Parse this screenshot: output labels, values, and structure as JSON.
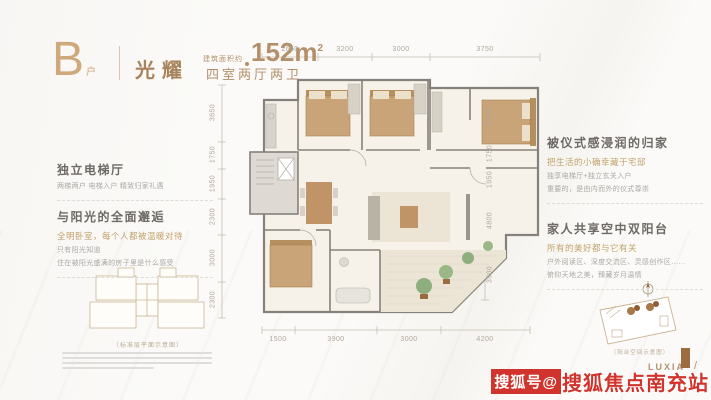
{
  "header": {
    "unit": "B",
    "unit_suffix": "户",
    "name": "光耀",
    "area_prefix": "建筑面积约",
    "area_value": "152m",
    "area_sup": "2",
    "layout": "四室两厅两卫"
  },
  "features_left": [
    {
      "title": "独立电梯厅",
      "lines": [
        "两梯两户 电梯入户 精致归家礼遇"
      ]
    },
    {
      "title": "与阳光的全面邂逅",
      "gold": "全明卧室，每个人都被温暖对待",
      "lines": [
        "只有阳光知道",
        "住在被阳光盛满的房子里是什么感受"
      ]
    }
  ],
  "features_right": [
    {
      "title": "被仪式感浸润的归家",
      "gold": "把生活的小确幸藏于宅邸",
      "lines": [
        "独享电梯厅+独立玄关入户",
        "重要的，是由内而外的仪式尊崇"
      ]
    },
    {
      "title": "家人共享空中双阳台",
      "gold": "所有的美好都与它有关",
      "lines": [
        "户外阅读区、深度交流区、灵感创作区……",
        "俯仰天地之美，臻藏岁月温情"
      ]
    }
  ],
  "floorplan": {
    "dims_top": [
      "2650",
      "3200",
      "3000",
      "3750"
    ],
    "dims_bottom": [
      "1500",
      "3900",
      "3000",
      "4200"
    ],
    "dims_left": [
      "3650",
      "1750",
      "1950",
      "2300",
      "3000",
      "2300"
    ],
    "dims_right": [
      "5400",
      "1750",
      "1950",
      "4800",
      "3900"
    ]
  },
  "footer": {
    "keyplan_caption": "（标准层平面示意图）",
    "balcony_caption": "（阳台空间示意图）",
    "logo": "LUXIA",
    "watermark_prefix": "搜狐号@",
    "watermark_name": "搜狐焦点南充站"
  },
  "colors": {
    "accent_bronze": "#b3906a",
    "gold_text": "#c2a26c",
    "wall_gray": "#85817a",
    "plant_green": "#8fae7e",
    "watermark_red": "#d0342c"
  }
}
